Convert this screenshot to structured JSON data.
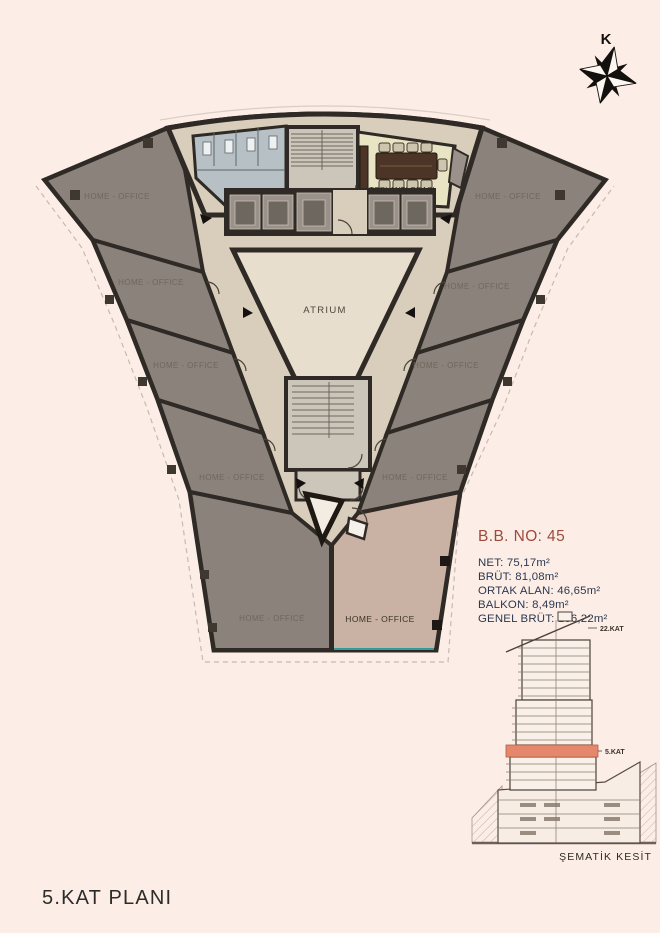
{
  "title": "5.KAT PLANI",
  "compass": {
    "north_label": "K"
  },
  "plan": {
    "atrium_label": "ATRIUM",
    "meeting_room_label": "TOPLANTI ODASI",
    "office_units": [
      "HOME - OFFICE",
      "HOME - OFFICE",
      "HOME - OFFICE",
      "HOME - OFFICE",
      "HOME - OFFICE",
      "HOME - OFFICE",
      "HOME - OFFICE",
      "HOME - OFFICE",
      "HOME - OFFICE",
      "HOME - OFFICE"
    ],
    "highlighted_unit_index": 9
  },
  "unit_info": {
    "number": "B.B. NO: 45",
    "lines": [
      "NET: 75,17m²",
      "BRÜT: 81,08m²",
      "ORTAK ALAN: 46,65m²",
      "BALKON: 8,49m²",
      "GENEL BRÜT: 136,22m²"
    ]
  },
  "section": {
    "top_floor_label": "22.KAT",
    "current_floor_label": "5.KAT",
    "caption": "ŞEMATİK KESİT"
  },
  "colors": {
    "background": "#fceee7",
    "unit_gray": "#8b837b",
    "unit_highlighted": "#c9b2a4",
    "corridor": "#d9cebc",
    "atrium": "#e8decd",
    "wall": "#2f2a25",
    "meeting_room": "#e9e4c4",
    "wc": "#b7c1c5",
    "accent_red": "#9e4b3c",
    "info_navy": "#2b3850",
    "section_highlight": "#e4876c",
    "balcony_teal": "#2f9e98"
  }
}
